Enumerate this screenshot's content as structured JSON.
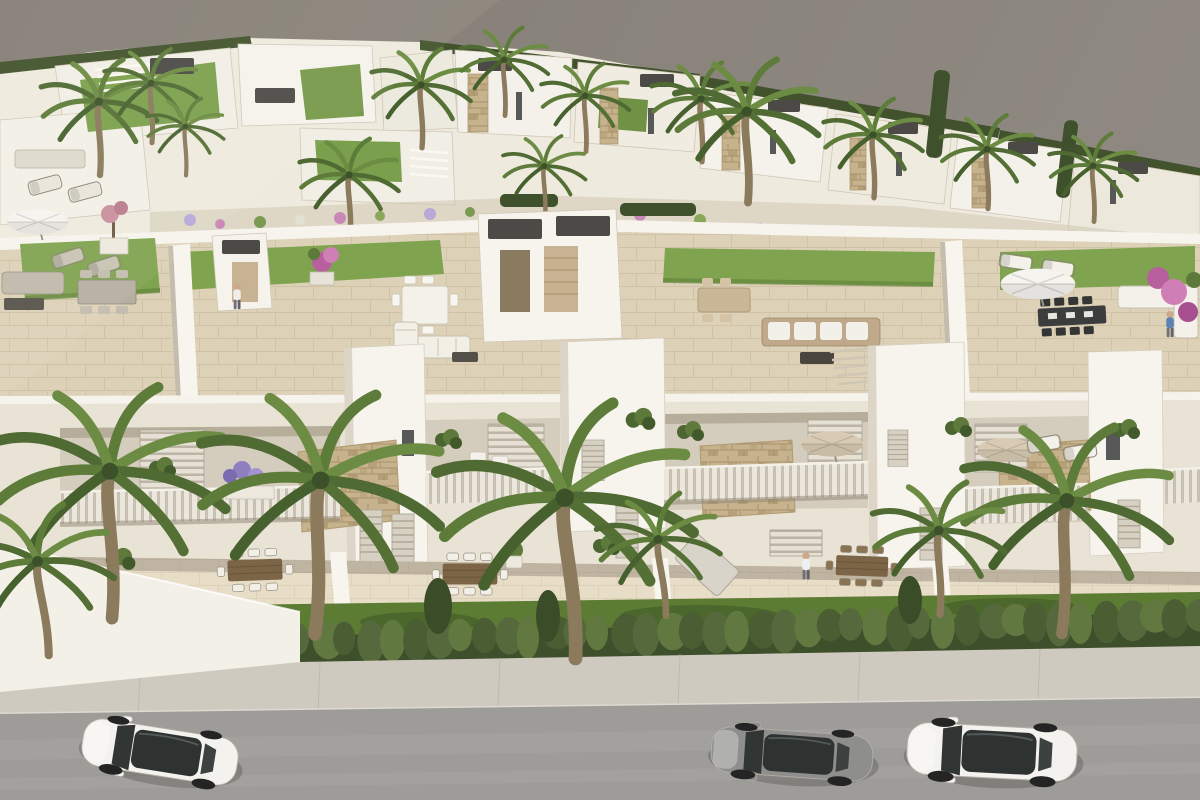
{
  "scene": {
    "kind": "3d-architectural-rendering",
    "subject": "aerial view of a white modern residential development with rooftop solarium terraces, balconies with stone-clad accents, ground-floor terraces, gardens, palm trees, a dense front hedge, sidewalk and street with parked cars",
    "camera": "high oblique aerial",
    "lighting": "sunny daylight from upper left"
  },
  "palette": {
    "backdrop": "#8a847c",
    "wall_light": "#efeade",
    "wall_bright": "#f7f4ee",
    "facade": "#e9e3d6",
    "tile_floor": "#ddd2b8",
    "ground_floor": "#e8dec8",
    "lawn_roof": "#7fa34f",
    "garden_grass": "#5c7c33",
    "hedge_shadow": "#3e4f2b",
    "sidewalk": "#cfcabf",
    "road": "#9d9c99",
    "stone_clad": "#c6b28c",
    "dark_box": "#4b4a47",
    "wood": "#7c6546",
    "dark_furniture": "#3c3d3d",
    "umbrella_white": "#f6f4ef",
    "umbrella_tan": "#d9cbb3",
    "car_white": "#f4f2ee",
    "car_gray": "#8e8e8c",
    "glass_dark": "#2e3332",
    "palm_green": "#5d7c3a",
    "flower_pink": "#cf7fb5",
    "flower_purple": "#8f7fc0"
  },
  "objects": {
    "cars": [
      {
        "id": "car-left",
        "type": "suv",
        "body": "white",
        "roof": "dark glass"
      },
      {
        "id": "car-middle",
        "type": "coupe",
        "body": "gray",
        "roof": "dark glass"
      },
      {
        "id": "car-right",
        "type": "sedan",
        "body": "white",
        "roof": "dark glass"
      }
    ],
    "people": [
      {
        "id": "person-roof-left",
        "location": "left roof terrace"
      },
      {
        "id": "person-roof-right",
        "location": "right roof terrace railing"
      },
      {
        "id": "person-ground-center",
        "location": "center ground terrace"
      }
    ],
    "roof_terraces": 4,
    "parasols": 4,
    "foreground_palms": 7,
    "hedge": {
      "count": 40,
      "colors": [
        "#55693c",
        "#617841",
        "#4a5d33"
      ]
    }
  }
}
